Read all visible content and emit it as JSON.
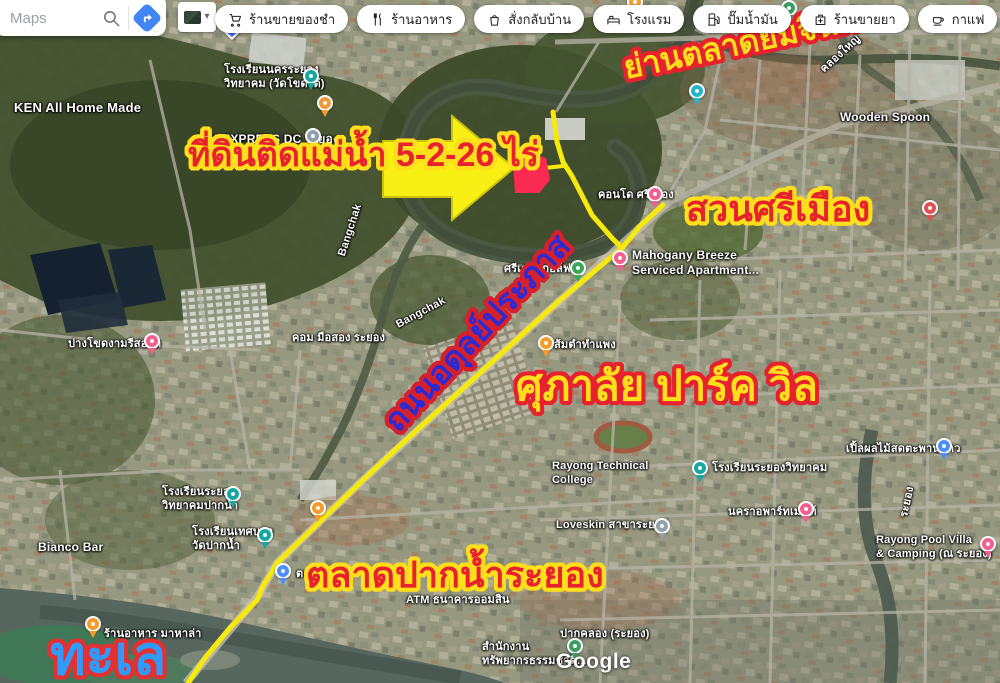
{
  "header": {
    "search": {
      "placeholder": "Maps"
    },
    "layers_caret": "▾",
    "pills": [
      {
        "label": "ร้านขายของชำ",
        "icon": "cart-icon"
      },
      {
        "label": "ร้านอาหาร",
        "icon": "restaurant-icon"
      },
      {
        "label": "สั่งกลับบ้าน",
        "icon": "takeout-icon"
      },
      {
        "label": "โรงแรม",
        "icon": "bed-icon"
      },
      {
        "label": "ปั๊มน้ำมัน",
        "icon": "fuel-icon"
      },
      {
        "label": "ร้านขายยา",
        "icon": "pharmacy-icon"
      },
      {
        "label": "กาแฟ",
        "icon": "coffee-icon"
      }
    ]
  },
  "map": {
    "watermark": "Google",
    "route": {
      "color": "#f7e90c",
      "main": "663,205 640,226 622,248 560,300 470,382 395,450 363,480 277,563 262,588 257,600 230,628 205,658 188,683",
      "north": "553,112 557,142 563,162 572,176 592,215 612,238 622,248",
      "spur": "563,166 545,168"
    },
    "land_plot": {
      "color": "#fb2a52",
      "points": "513,162 529,153 546,158 550,180 539,193 515,193"
    },
    "arrow": {
      "fill": "#f8ef14",
      "stroke": "#cfc20a",
      "points": "383,141 452,141 452,116 514,168 452,220 452,197 383,197"
    },
    "labels": [
      {
        "text": "KEN All Home Made",
        "x": 14,
        "y": 100,
        "size": 13
      },
      {
        "text": "โรงเรียนนครระยอง\nวิทยาคม (วัดโขดใต้)",
        "x": 224,
        "y": 64,
        "size": 11
      },
      {
        "text": "NIM EXPRESS DC ระยอง",
        "x": 196,
        "y": 132,
        "size": 12
      },
      {
        "text": "คลองใหญ่",
        "x": 818,
        "y": 66,
        "size": 11,
        "rotate": -42
      },
      {
        "text": "Wooden Spoon",
        "x": 840,
        "y": 110,
        "size": 12
      },
      {
        "text": "ศรีเดชะกอล์ฟ",
        "x": 504,
        "y": 263,
        "size": 11
      },
      {
        "text": "Mahogany Breeze\nServiced Apartment...",
        "x": 632,
        "y": 248,
        "size": 12
      },
      {
        "text": "คอนโด ศรีเมือง",
        "x": 598,
        "y": 189,
        "size": 11
      },
      {
        "text": "ส้มตำทำแพง",
        "x": 554,
        "y": 339,
        "size": 11
      },
      {
        "text": "คอม มือสอง ระยอง",
        "x": 292,
        "y": 332,
        "size": 11
      },
      {
        "text": "ปางโขดงามรีสอร์ท",
        "x": 68,
        "y": 338,
        "size": 11
      },
      {
        "text": "Bangchak",
        "x": 394,
        "y": 320,
        "size": 11,
        "rotate": -28
      },
      {
        "text": "Bangchak",
        "x": 336,
        "y": 254,
        "size": 11,
        "rotate": -72
      },
      {
        "text": "โรงเรียนระยองวิทยาคม",
        "x": 712,
        "y": 462,
        "size": 11
      },
      {
        "text": "Rayong Technical\nCollege",
        "x": 552,
        "y": 460,
        "size": 11
      },
      {
        "text": "นคราอพาร์ทเมนท์",
        "x": 728,
        "y": 506,
        "size": 11
      },
      {
        "text": "เปิ้ลผลไม้สดตะพานขาว",
        "x": 846,
        "y": 443,
        "size": 11
      },
      {
        "text": "Rayong Pool Villa\n& Camping (ณ ระยอง)",
        "x": 876,
        "y": 534,
        "size": 11
      },
      {
        "text": "Loveskin สาขาระยอง",
        "x": 556,
        "y": 519,
        "size": 11
      },
      {
        "text": "โรงเรียนระยอง\nวิทยาคมปากน้ำ",
        "x": 162,
        "y": 486,
        "size": 11
      },
      {
        "text": "โรงเรียนเทศบาล\nวัดปากน้ำ",
        "x": 192,
        "y": 526,
        "size": 11
      },
      {
        "text": "ปากคลอง (ระยอง)",
        "x": 560,
        "y": 628,
        "size": 11
      },
      {
        "text": "สำนักงาน\nทรัพยากรธรรมชาติ...",
        "x": 482,
        "y": 641,
        "size": 11
      },
      {
        "text": "ATM ธนาคารออมสิน",
        "x": 406,
        "y": 594,
        "size": 11
      },
      {
        "text": "ร้านอาหาร มาหาล่า",
        "x": 104,
        "y": 628,
        "size": 11
      },
      {
        "text": "Bianco Bar",
        "x": 38,
        "y": 540,
        "size": 12
      },
      {
        "text": "ระยอง",
        "x": 898,
        "y": 516,
        "size": 11,
        "rotate": -78
      },
      {
        "text": "ตลาด",
        "x": 296,
        "y": 568,
        "size": 11
      }
    ],
    "pins": [
      {
        "type": "nav",
        "color": "#4273f5",
        "x": 232,
        "y": 30
      },
      {
        "type": "cafe",
        "color": "#ef9a3a",
        "x": 325,
        "y": 103
      },
      {
        "type": "place-gray",
        "color": "#90a0ac",
        "x": 313,
        "y": 136
      },
      {
        "type": "school",
        "color": "#16a7a1",
        "x": 311,
        "y": 76
      },
      {
        "type": "school",
        "color": "#16a7a1",
        "x": 233,
        "y": 494
      },
      {
        "type": "school",
        "color": "#16a7a1",
        "x": 265,
        "y": 535
      },
      {
        "type": "school",
        "color": "#16a7a1",
        "x": 700,
        "y": 468
      },
      {
        "type": "golf",
        "color": "#3aa757",
        "x": 578,
        "y": 268
      },
      {
        "type": "hotel",
        "color": "#f2608f",
        "x": 620,
        "y": 258
      },
      {
        "type": "hotel",
        "color": "#f2608f",
        "x": 655,
        "y": 194
      },
      {
        "type": "hotel",
        "color": "#f2608f",
        "x": 806,
        "y": 509
      },
      {
        "type": "hotel",
        "color": "#f2608f",
        "x": 988,
        "y": 544
      },
      {
        "type": "hotel",
        "color": "#f2608f",
        "x": 152,
        "y": 341
      },
      {
        "type": "food",
        "color": "#f49b2a",
        "x": 546,
        "y": 343
      },
      {
        "type": "food",
        "color": "#f49b2a",
        "x": 318,
        "y": 508
      },
      {
        "type": "food",
        "color": "#f49b2a",
        "x": 93,
        "y": 624
      },
      {
        "type": "shop",
        "color": "#4c8df6",
        "x": 283,
        "y": 571
      },
      {
        "type": "shop",
        "color": "#4c8df6",
        "x": 944,
        "y": 446
      },
      {
        "type": "transit",
        "color": "#23b5c8",
        "x": 697,
        "y": 91
      },
      {
        "type": "gov",
        "color": "#3c9c62",
        "x": 789,
        "y": 8
      },
      {
        "type": "place-orange",
        "color": "#f0a030",
        "x": 635,
        "y": 2
      },
      {
        "type": "place-gray",
        "color": "#90a0ac",
        "x": 662,
        "y": 526
      },
      {
        "type": "gov",
        "color": "#3c9c62",
        "x": 575,
        "y": 646
      },
      {
        "type": "place-red",
        "color": "#e05252",
        "x": 930,
        "y": 208
      }
    ]
  },
  "annotations": [
    {
      "id": "land-annotation",
      "text": "ที่ดินติดแม่น้ำ 5-2-26 ไร่",
      "x": 188,
      "y": 130,
      "size": 34,
      "style": "red-yellow"
    },
    {
      "id": "yommajinda-annotation",
      "text": "ย่านตลาดยมจินดา",
      "x": 624,
      "y": 44,
      "size": 32,
      "style": "yellow-red",
      "rotate": -12
    },
    {
      "id": "suan-sri-mueang-annotation",
      "text": "สวนศรีเมือง",
      "x": 686,
      "y": 182,
      "size": 36,
      "style": "red-yellow"
    },
    {
      "id": "road-annotation",
      "text": "ถนนอดุลย์ประภาส",
      "x": 390,
      "y": 402,
      "size": 32,
      "style": "blue-red",
      "rotate": -47
    },
    {
      "id": "supalai-annotation",
      "text": "ศุภาลัย ปาร์ค วิล",
      "x": 516,
      "y": 354,
      "size": 42,
      "style": "yellow-red"
    },
    {
      "id": "talad-paknam-annotation",
      "text": "ตลาดปากน้ำระยอง",
      "x": 306,
      "y": 548,
      "size": 36,
      "style": "red-yellow"
    },
    {
      "id": "sea-annotation",
      "text": "ทะเล",
      "x": 50,
      "y": 616,
      "size": 54,
      "style": "sky-red"
    }
  ]
}
